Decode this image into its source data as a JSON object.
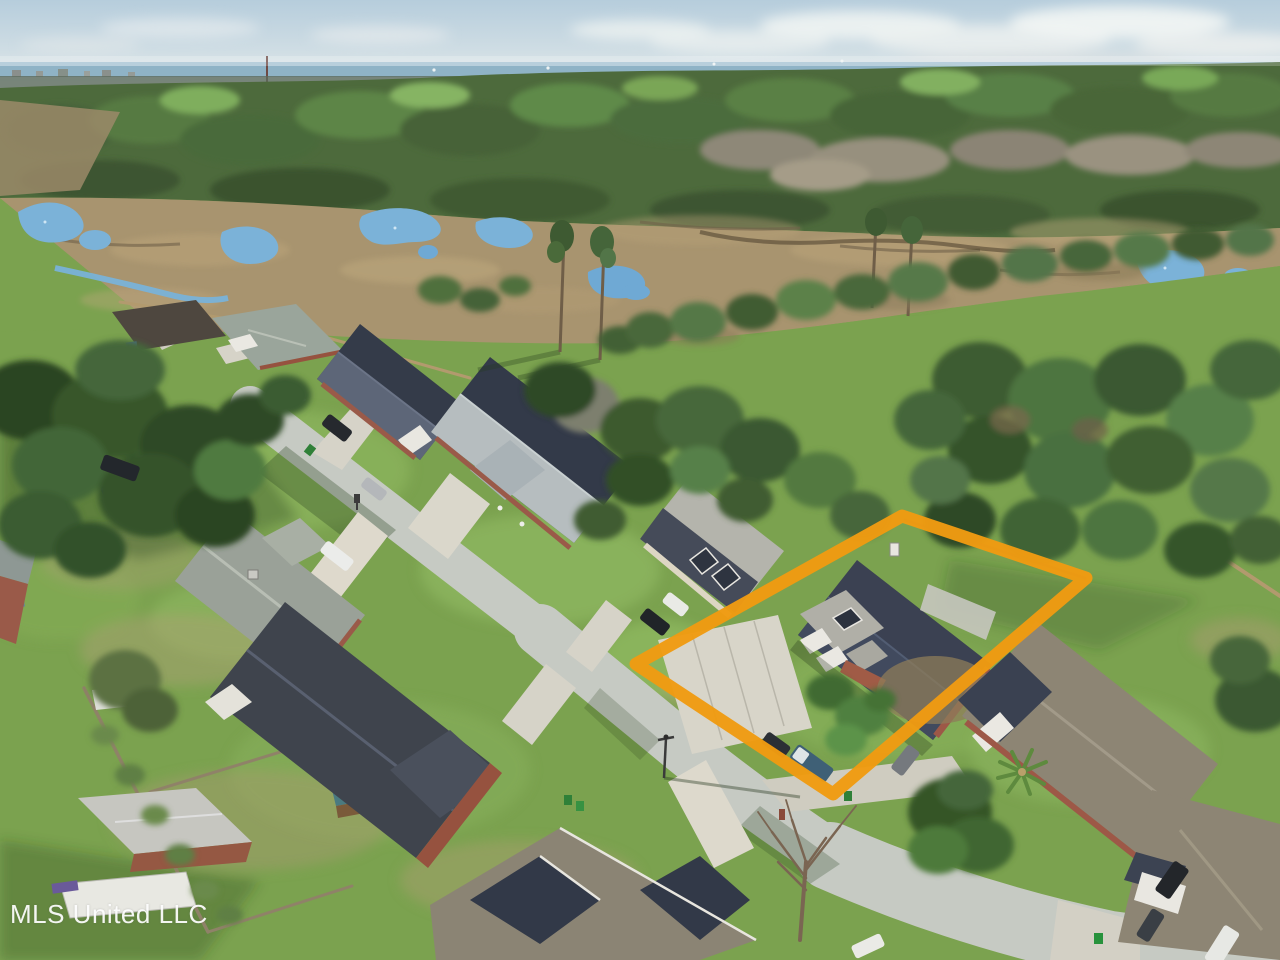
{
  "image": {
    "kind": "aerial-drone-photograph",
    "subject": "Suburban neighborhood street with brick houses, marsh and forest beyond, one residential lot highlighted"
  },
  "watermark": {
    "text": "MLS United LLC",
    "color": "#FFFFFF"
  },
  "property_outline": {
    "color": "#F09B12",
    "shape": "quadrilateral",
    "corners": [
      [
        902,
        516
      ],
      [
        1086,
        578
      ],
      [
        833,
        794
      ],
      [
        636,
        664
      ]
    ]
  },
  "palette": {
    "sky": "#c3d4e0",
    "bay_water": "#8fb3c6",
    "forest": "#4d6a3c",
    "marsh": "#a8946f",
    "creek": "#79b2d8",
    "lawn": "#7ba24f",
    "street": "#c6cac3",
    "driveway": "#d8d5c9",
    "roof_dark": "#3b4152",
    "roof_light": "#b2b1a9",
    "roof_warm_gray": "#8d8574",
    "brick": "#9d5847"
  }
}
